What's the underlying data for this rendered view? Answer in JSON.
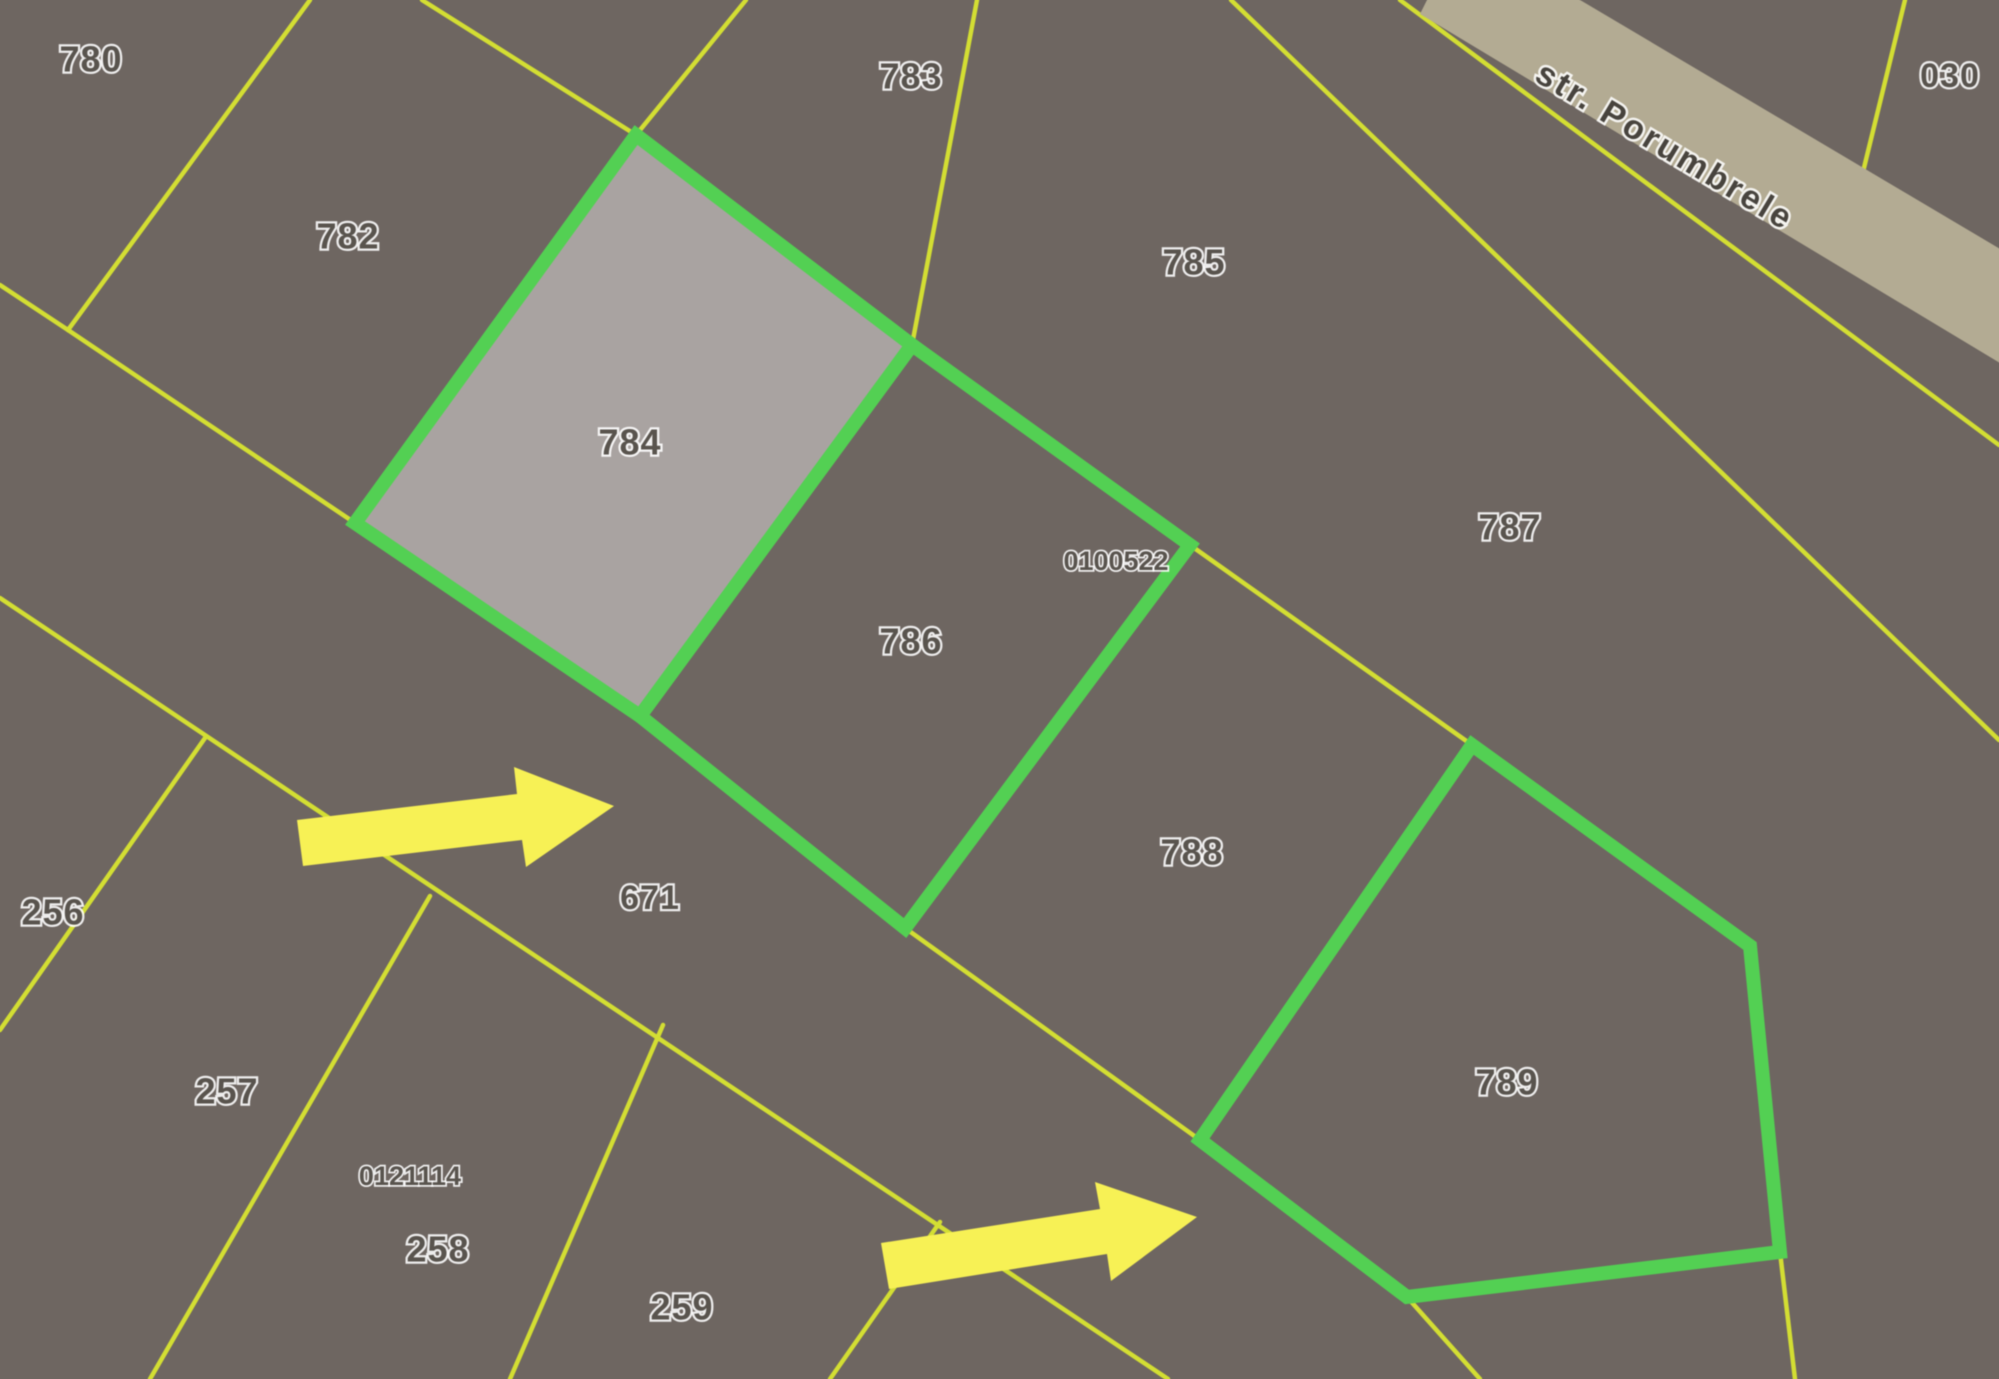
{
  "map": {
    "width": 1999,
    "height": 1379,
    "colors": {
      "background": "#6e6661",
      "parcel_line": "#d3de33",
      "highlight_stroke": "#53d053",
      "highlight_fill": "#a9a3a1",
      "road_fill": "#b3ab93",
      "label_fill": "#59544e",
      "label_outline": "#ffffff",
      "street_text": "#48443e",
      "arrow_fill": "#f7f155"
    },
    "street": {
      "name": "str. Porumbrele",
      "x": 1664,
      "y": 148,
      "angle": 31,
      "font_size": 34,
      "band_points": "1420,14 1462,-70 2120,320 2078,410"
    },
    "boundary_lines": [
      {
        "name": "edge-left-top",
        "points": "0,285 68,330"
      },
      {
        "name": "divider-780-782",
        "points": "68,330 310,0"
      },
      {
        "name": "divider-782-sliver",
        "points": "422,0 636,135"
      },
      {
        "name": "divider-sliver-783",
        "points": "746,0 636,135"
      },
      {
        "name": "divider-783-785",
        "points": "977,0 912,345"
      },
      {
        "name": "divider-785-787",
        "points": "1231,0 1999,740"
      },
      {
        "name": "road-side-line",
        "points": "1400,0 1999,445"
      },
      {
        "name": "divider-030",
        "points": "1905,0 1862,176"
      },
      {
        "name": "road-strip-top-edge",
        "points": "68,330 355,523 640,716 905,928 1200,1140 1407,1297 1480,1379"
      },
      {
        "name": "divider-787-788-789",
        "points": "912,345 1190,545 1472,745 1750,946 1780,1252 1795,1379"
      },
      {
        "name": "road-strip-bottom-edge",
        "points": "0,598 1168,1379"
      },
      {
        "name": "divider-256-257",
        "points": "205,738 0,1030"
      },
      {
        "name": "divider-257-258",
        "points": "430,896 150,1379"
      },
      {
        "name": "divider-258-259",
        "points": "663,1025 510,1379"
      },
      {
        "name": "divider-259-next",
        "points": "940,1222 830,1379"
      }
    ],
    "highlights": [
      {
        "parcel": "784",
        "points": "636,135 912,345 640,716 355,523",
        "filled": true
      },
      {
        "parcel": "786",
        "points": "912,345 1190,545 905,928 640,716",
        "filled": false
      },
      {
        "parcel": "789",
        "points": "1472,745 1750,946 1780,1252 1407,1297 1200,1140",
        "filled": false
      }
    ],
    "labels": [
      {
        "label": "780",
        "x": 91,
        "y": 62,
        "kind": "parcel",
        "size": 36
      },
      {
        "label": "782",
        "x": 348,
        "y": 239,
        "kind": "parcel",
        "size": 36
      },
      {
        "label": "783",
        "x": 911,
        "y": 79,
        "kind": "parcel",
        "size": 36
      },
      {
        "label": "784",
        "x": 630,
        "y": 445,
        "kind": "parcel",
        "size": 36
      },
      {
        "label": "785",
        "x": 1194,
        "y": 265,
        "kind": "parcel",
        "size": 36
      },
      {
        "label": "786",
        "x": 911,
        "y": 644,
        "kind": "parcel",
        "size": 36
      },
      {
        "label": "787",
        "x": 1510,
        "y": 530,
        "kind": "parcel",
        "size": 36
      },
      {
        "label": "788",
        "x": 1192,
        "y": 855,
        "kind": "parcel",
        "size": 36
      },
      {
        "label": "789",
        "x": 1507,
        "y": 1085,
        "kind": "parcel",
        "size": 36
      },
      {
        "label": "030",
        "x": 1950,
        "y": 78,
        "kind": "parcel",
        "size": 34
      },
      {
        "label": "671",
        "x": 650,
        "y": 900,
        "kind": "parcel",
        "size": 34
      },
      {
        "label": "256",
        "x": 53,
        "y": 915,
        "kind": "parcel",
        "size": 36
      },
      {
        "label": "257",
        "x": 227,
        "y": 1094,
        "kind": "parcel",
        "size": 36
      },
      {
        "label": "258",
        "x": 438,
        "y": 1252,
        "kind": "parcel",
        "size": 36
      },
      {
        "label": "259",
        "x": 682,
        "y": 1310,
        "kind": "parcel",
        "size": 36
      },
      {
        "label": "0100522",
        "x": 1116,
        "y": 563,
        "kind": "code",
        "size": 27
      },
      {
        "label": "0121114",
        "x": 410,
        "y": 1178,
        "kind": "code",
        "size": 27
      }
    ],
    "arrows": [
      {
        "name": "annotation-arrow-1",
        "points": "297,820 517,794 514,767 614,806 526,867 522,840 303,866"
      },
      {
        "name": "annotation-arrow-2",
        "points": "881,1243 1100,1209 1095,1182 1197,1217 1111,1281 1107,1254 889,1289"
      }
    ]
  }
}
